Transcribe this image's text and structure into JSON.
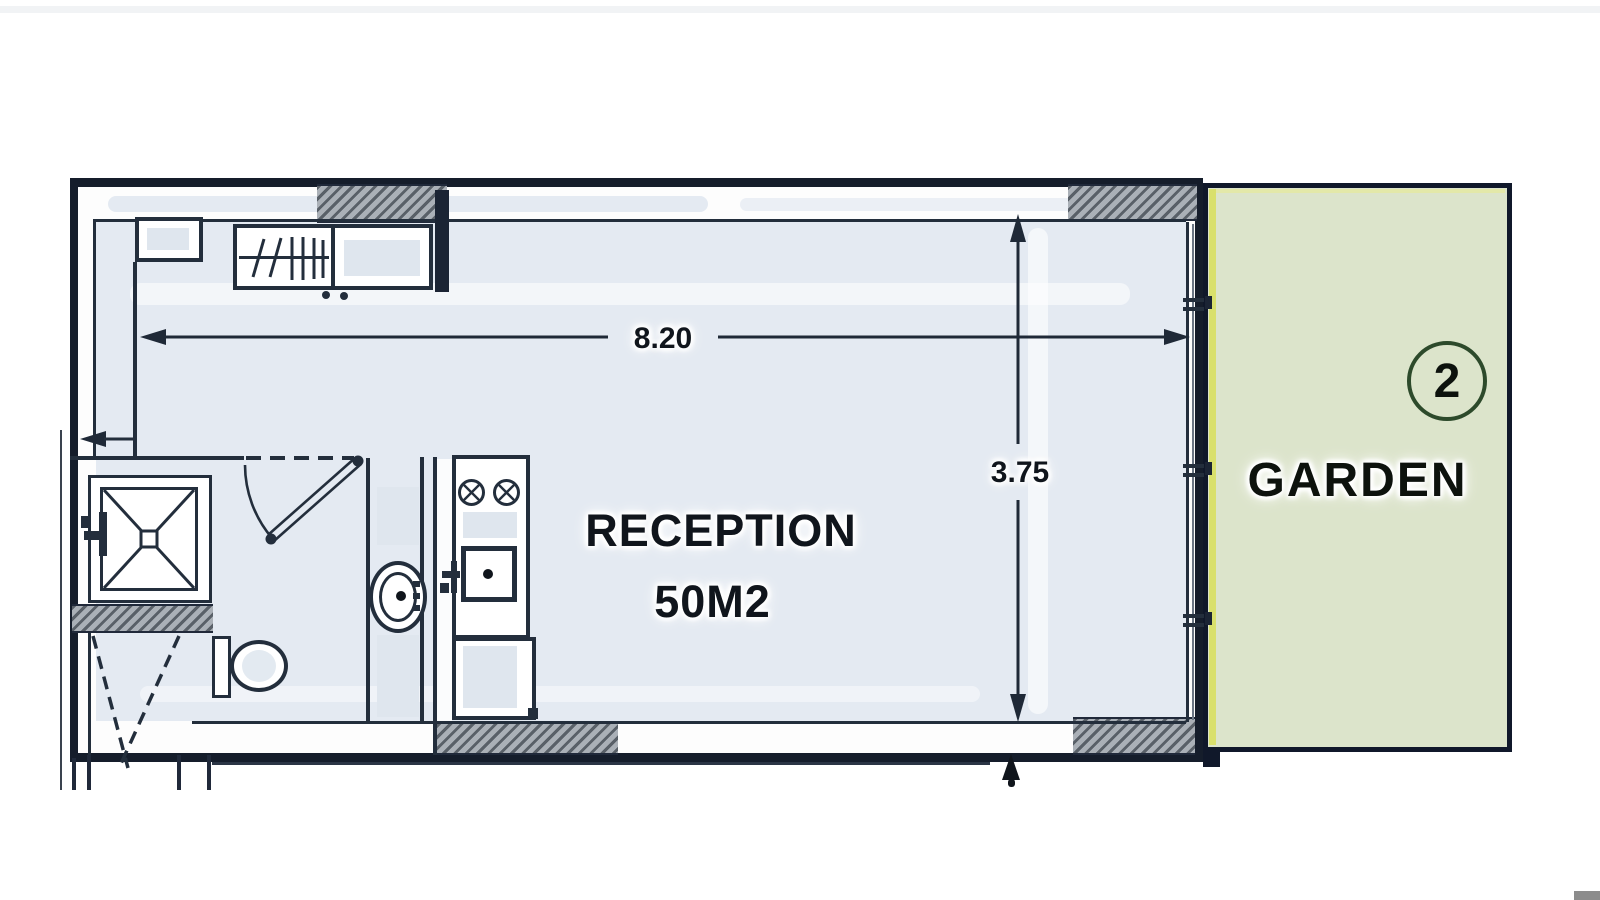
{
  "plan": {
    "type": "apartment-floor-plan",
    "room": {
      "name": "RECEPTION",
      "area": "50M2"
    },
    "garden": {
      "label": "GARDEN",
      "unit_number": "2"
    },
    "dimensions": {
      "width_m": "8.20",
      "depth_m": "3.75"
    },
    "colors": {
      "wall": "#151d2b",
      "line": "#232e3c",
      "floor_fill": "#e4eaf2",
      "garden_fill": "#dce4cb",
      "garden_edge": "#d9e06c",
      "garden_circle_stroke": "#2d4a2b",
      "hatch_dark": "#596068",
      "hatch_light": "#aab0b7"
    }
  }
}
